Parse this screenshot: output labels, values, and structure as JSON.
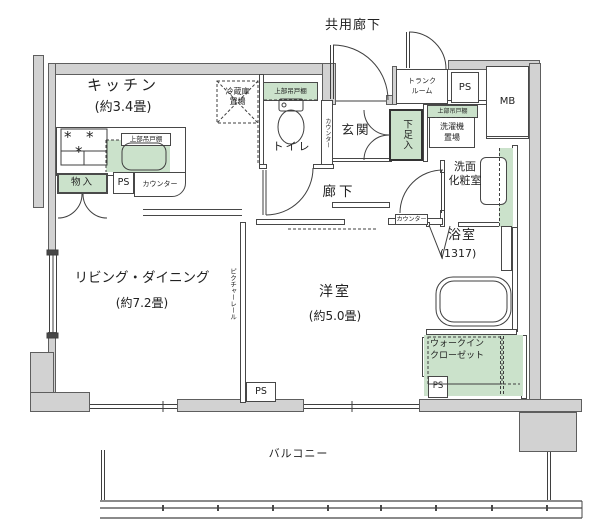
{
  "labels": {
    "common_corridor": "共用廊下",
    "balcony": "バルコニー",
    "hallway": "廊下",
    "entrance": "玄関",
    "toilet": "トイレ",
    "kitchen": "キッチン",
    "kitchen_size": "(約3.4畳)",
    "living_dining": "リビング・ダイニング",
    "living_dining_size": "(約7.2畳)",
    "western_room": "洋室",
    "western_room_size": "(約5.0畳)",
    "bathroom": "浴室",
    "bathroom_size": "(1317)",
    "washroom": "洗面\n化粧室",
    "walk_in_closet": "ウォークイン\nクローゼット",
    "trunk_room": "トランク\nルーム",
    "refrigerator_space": "冷蔵庫\n置場",
    "washer_space": "洗濯機\n置場",
    "upper_cabinet": "上部吊戸棚",
    "storage": "物入",
    "shoe_cabinet": "下足入",
    "counter": "カウンター",
    "picture_rail": "ピクチャーレール",
    "ps": "PS",
    "mb": "MB"
  },
  "colors": {
    "wall_fill": "#d2d2d2",
    "accent_green": "#cbe2cb",
    "line": "#474747"
  }
}
